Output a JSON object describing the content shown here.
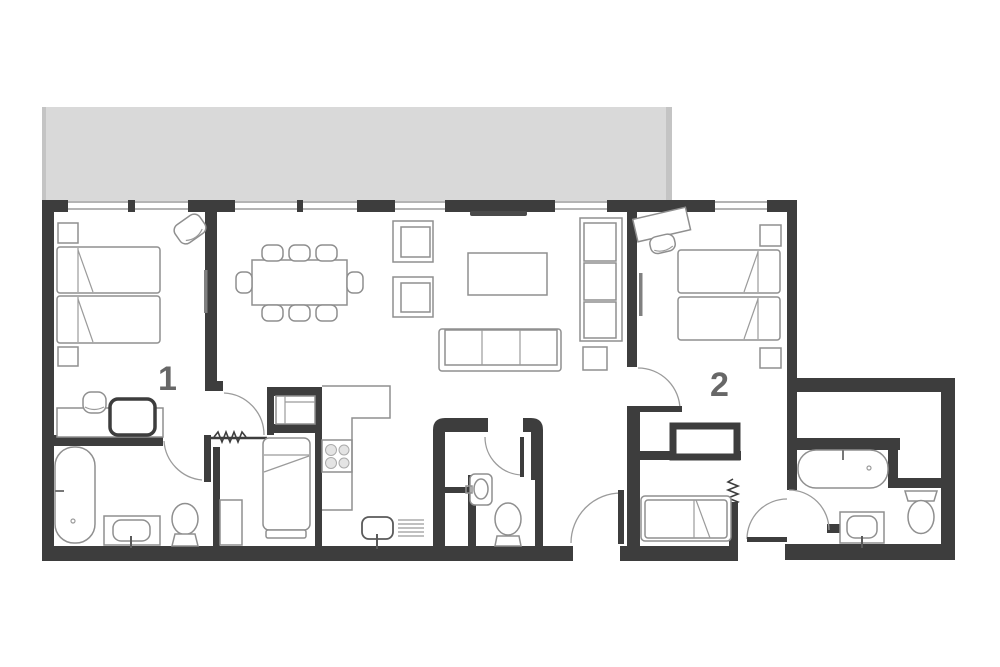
{
  "floorplan": {
    "title": "two-bedroom apartment floor plan with balcony",
    "rooms": {
      "bedroom1": {
        "label": "1",
        "furniture": [
          "twin-bed",
          "twin-bed",
          "nightstand",
          "nightstand",
          "chair",
          "desk",
          "stool",
          "ottoman"
        ]
      },
      "bedroom2": {
        "label": "2",
        "furniture": [
          "twin-bed",
          "twin-bed",
          "nightstand",
          "nightstand",
          "desk",
          "stool",
          "closet",
          "single-bed"
        ]
      },
      "living_dining": {
        "furniture": [
          "dining-table",
          "dining-chairs-x8",
          "armchair",
          "armchair",
          "tv",
          "coffee-table",
          "sofa",
          "shelf-unit",
          "side-table"
        ]
      },
      "kitchen": {
        "furniture": [
          "counter",
          "stove-4-burners",
          "sink",
          "drying-rack"
        ]
      },
      "bathroom1": {
        "furniture": [
          "bathtub",
          "vanity-sink",
          "toilet"
        ]
      },
      "wc": {
        "furniture": [
          "wall-sink",
          "toilet"
        ]
      },
      "bathroom2": {
        "furniture": [
          "bathtub",
          "vanity-sink",
          "toilet"
        ]
      },
      "box_room": {
        "furniture": [
          "single-bed",
          "wardrobe"
        ]
      },
      "balcony": {
        "furniture": []
      }
    },
    "colors": {
      "wall": "#3d3d3d",
      "balcony": "#d9d9d9",
      "balcony_edge": "#c4c4c4",
      "furniture_stroke": "#8f8f8f",
      "label": "#676767",
      "background": "#ffffff",
      "tv": "#4a4a4a"
    }
  }
}
